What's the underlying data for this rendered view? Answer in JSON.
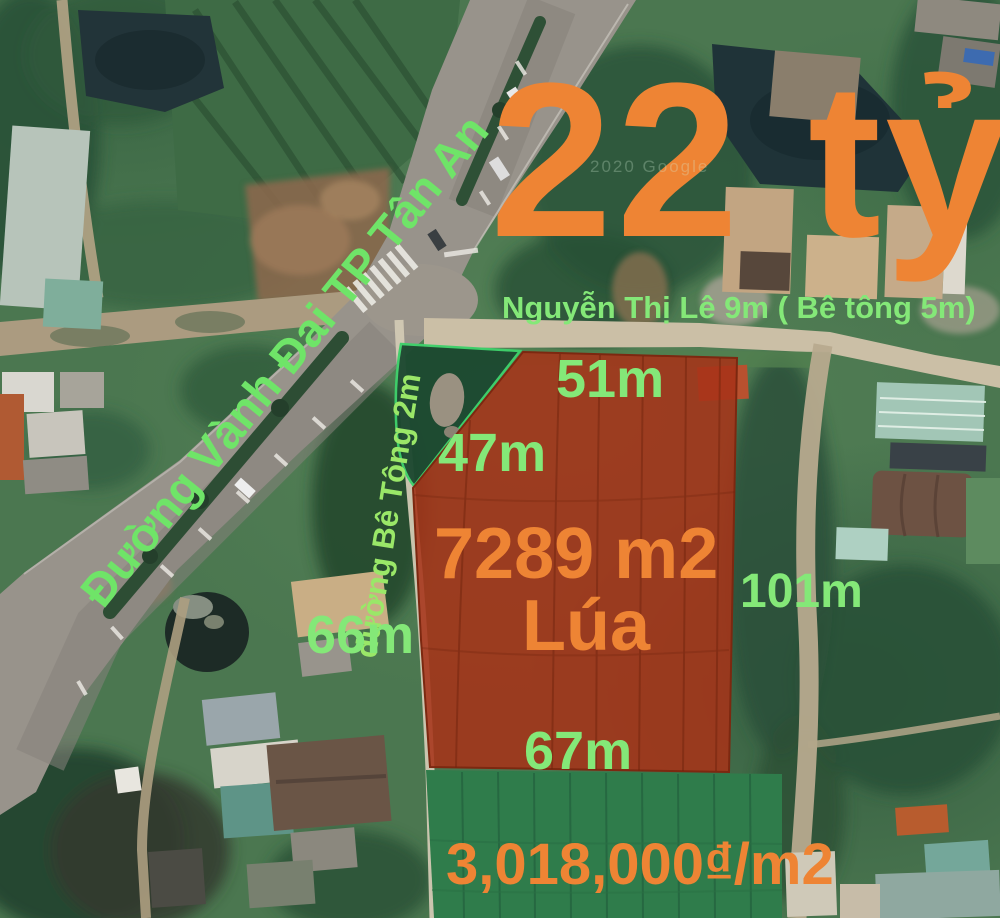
{
  "price": {
    "main": "22 tỷ",
    "per_m2": "3,018,000₫/m2"
  },
  "parcel": {
    "area": "7289 m2",
    "land_use": "Lúa",
    "edges": {
      "north": "51m",
      "northwest": "47m",
      "east": "101m",
      "west": "66m",
      "south": "67m"
    }
  },
  "roads": {
    "ring": "Đường Vành Đai TP Tân An",
    "front": "Nguyễn Thị Lê 9m ( Bê tông 5m)",
    "concrete": "đường Bê Tông 2m"
  },
  "map": {
    "watermark": "2020 Google"
  },
  "colors": {
    "accent_orange": "#EE8434",
    "label_green": "#84E878",
    "road_label_green": "#6FE468",
    "path_label_green": "#9AE768",
    "parcel_red": "#A63318"
  }
}
